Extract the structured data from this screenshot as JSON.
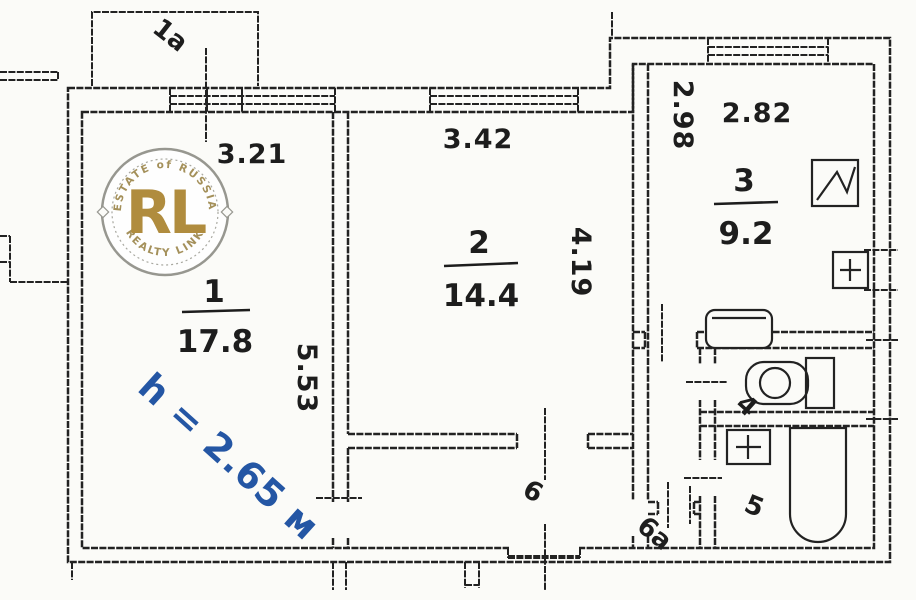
{
  "title": "Apartment floor plan scan",
  "colors": {
    "paper": "#fbfbf8",
    "ink": "#222222",
    "height_note_blue": "#2456a4",
    "watermark_gold": "#b08c3e",
    "watermark_ring_gray": "#979790"
  },
  "labels": {
    "balcony": "1a",
    "height_note": "h = 2.65 м",
    "dim_room1_width": "3.21",
    "dim_room1_depth": "5.53",
    "dim_room2_width": "3.42",
    "dim_room2_depth": "4.19",
    "dim_room3_depth": "2.98",
    "dim_room3_width": "2.82"
  },
  "rooms": {
    "room1": {
      "number": "1",
      "area": "17.8"
    },
    "room2": {
      "number": "2",
      "area": "14.4"
    },
    "room3": {
      "number": "3",
      "area": "9.2"
    },
    "room4": {
      "number": "4"
    },
    "room5": {
      "number": "5"
    },
    "room6": {
      "number": "6"
    },
    "room6a": {
      "number": "6a"
    }
  },
  "watermark": {
    "monogram": "RL",
    "arc_top": "ESTATE of RUSSIA",
    "arc_bottom": "REALTY LINK"
  }
}
